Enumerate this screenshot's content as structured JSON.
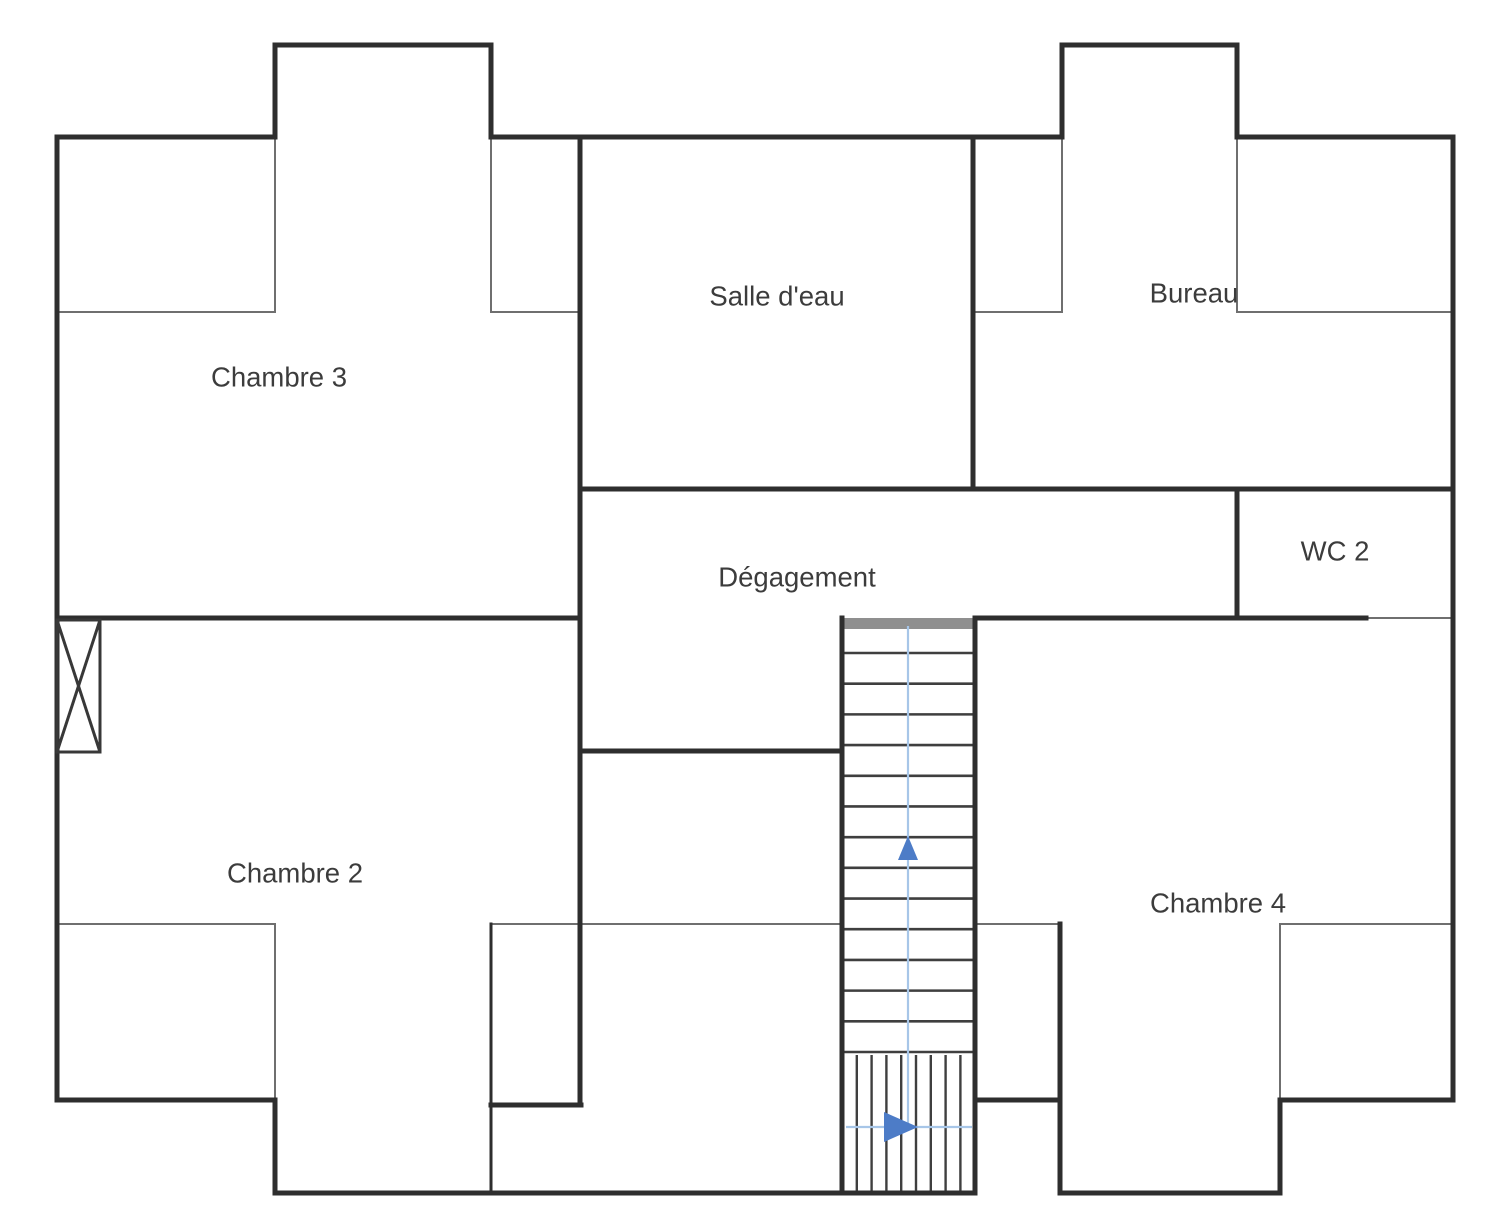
{
  "plan": {
    "canvas": {
      "width": 1500,
      "height": 1226,
      "background": "#ffffff"
    },
    "colors": {
      "wall": "#2e2e2e",
      "thin_line": "#6f6f6f",
      "tread": "#3f3f3f",
      "stair_landing": "#8f8f8f",
      "guide_line": "#a7c6e8",
      "arrow": "#4d7cc7",
      "label": "#3c3c3c"
    },
    "rooms": [
      {
        "id": "chambre-3",
        "label": "Chambre 3",
        "x": 279,
        "y": 377
      },
      {
        "id": "salle-d-eau",
        "label": "Salle d'eau",
        "x": 777,
        "y": 296
      },
      {
        "id": "bureau",
        "label": "Bureau",
        "x": 1194,
        "y": 293
      },
      {
        "id": "degagement",
        "label": "Dégagement",
        "x": 797,
        "y": 577
      },
      {
        "id": "wc-2",
        "label": "WC 2",
        "x": 1335,
        "y": 551
      },
      {
        "id": "chambre-2",
        "label": "Chambre 2",
        "x": 295,
        "y": 873
      },
      {
        "id": "chambre-4",
        "label": "Chambre 4",
        "x": 1218,
        "y": 903
      }
    ],
    "walls_thick": [
      [
        275,
        45,
        491,
        45
      ],
      [
        1062,
        45,
        1237,
        45
      ],
      [
        57,
        137,
        275,
        137
      ],
      [
        491,
        137,
        1062,
        137
      ],
      [
        1237,
        137,
        1453,
        137
      ],
      [
        580,
        489,
        1453,
        489
      ],
      [
        57,
        618,
        580,
        618
      ],
      [
        975,
        618,
        1366,
        618
      ],
      [
        580,
        751,
        842,
        751
      ],
      [
        57,
        1100,
        275,
        1100
      ],
      [
        975,
        1100,
        1060,
        1100
      ],
      [
        1280,
        1100,
        1453,
        1100
      ],
      [
        275,
        1193,
        975,
        1193
      ],
      [
        1060,
        1193,
        1280,
        1193
      ],
      [
        491,
        1105,
        581,
        1105
      ],
      [
        57,
        137,
        57,
        1100
      ],
      [
        1453,
        137,
        1453,
        1100
      ],
      [
        275,
        45,
        275,
        137
      ],
      [
        491,
        45,
        491,
        137
      ],
      [
        1062,
        45,
        1062,
        137
      ],
      [
        1237,
        45,
        1237,
        137
      ],
      [
        580,
        137,
        580,
        1105
      ],
      [
        973,
        137,
        973,
        489
      ],
      [
        1237,
        489,
        1237,
        618
      ],
      [
        275,
        1100,
        275,
        1193
      ],
      [
        1280,
        1100,
        1280,
        1193
      ],
      [
        842,
        618,
        842,
        1193
      ],
      [
        975,
        618,
        975,
        1193
      ],
      [
        1060,
        924,
        1060,
        1193
      ]
    ],
    "walls_medium": [
      [
        491,
        924,
        491,
        1193
      ]
    ],
    "walls_thin": [
      [
        57,
        312,
        275,
        312
      ],
      [
        491,
        312,
        580,
        312
      ],
      [
        973,
        312,
        1062,
        312
      ],
      [
        1237,
        312,
        1453,
        312
      ],
      [
        275,
        137,
        275,
        312
      ],
      [
        491,
        137,
        491,
        312
      ],
      [
        1062,
        137,
        1062,
        312
      ],
      [
        1237,
        137,
        1237,
        312
      ],
      [
        57,
        924,
        275,
        924
      ],
      [
        491,
        924,
        842,
        924
      ],
      [
        975,
        924,
        1060,
        924
      ],
      [
        1280,
        924,
        1453,
        924
      ],
      [
        275,
        924,
        275,
        1100
      ],
      [
        1280,
        924,
        1280,
        1100
      ],
      [
        1366,
        618,
        1450,
        618
      ]
    ],
    "flue": {
      "x": 57,
      "y": 620,
      "w": 43,
      "h": 132
    },
    "stairs": {
      "left": 842,
      "right": 975,
      "top": 618,
      "bottom": 1193,
      "landing_h": 11,
      "treads": {
        "first_y": 653,
        "last_y": 1052,
        "count": 14
      },
      "winder": {
        "top_y": 1055,
        "lines": 8,
        "spacing": 14.8
      },
      "up_guide": {
        "x": 908,
        "y1": 626,
        "y2": 1127
      },
      "up_arrow": [
        [
          898,
          860
        ],
        [
          918,
          860
        ],
        [
          908,
          836
        ]
      ],
      "exit_guide": {
        "y": 1127,
        "x1": 846,
        "x2": 972
      },
      "exit_arrow": [
        [
          884,
          1112
        ],
        [
          884,
          1142
        ],
        [
          918,
          1127
        ]
      ]
    }
  }
}
